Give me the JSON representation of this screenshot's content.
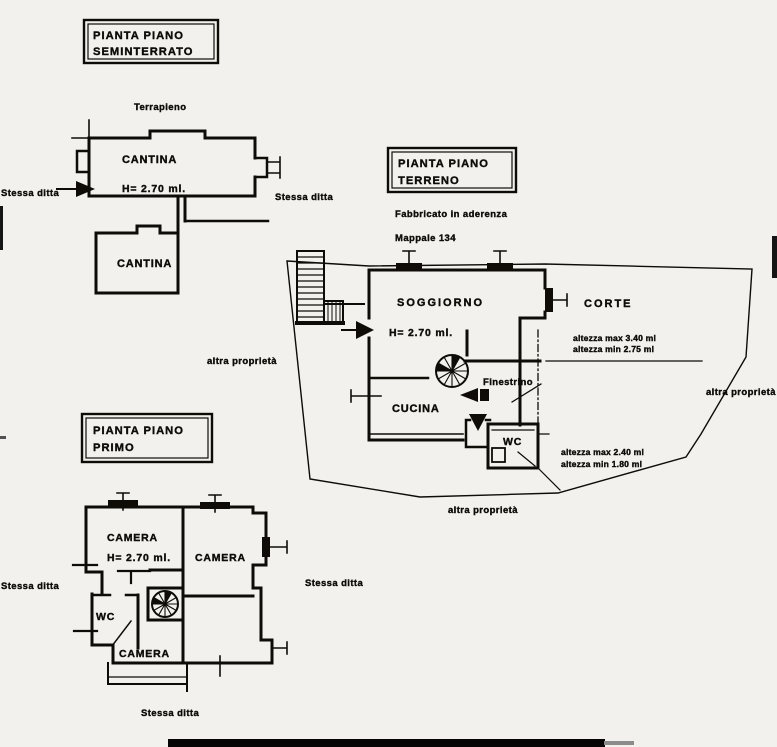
{
  "colors": {
    "paper": "#f2f1ed",
    "ink": "#16140f"
  },
  "seminterrato": {
    "title_line1": "PIANTA PIANO",
    "title_line2": "SEMINTERRATO",
    "note_terrapieno": "Terrapieno",
    "room_cantina_upper": "CANTINA",
    "height_label": "H= 2.70 ml.",
    "room_cantina_lower": "CANTINA",
    "note_left": "Stessa ditta",
    "note_right": "Stessa ditta"
  },
  "terreno": {
    "title_line1": "PIANTA PIANO",
    "title_line2": "TERRENO",
    "note_aderenza": "Fabbricato in aderenza",
    "note_mappale": "Mappale 134",
    "room_soggiorno": "SOGGIORNO",
    "height_label": "H= 2.70 ml.",
    "room_corte": "CORTE",
    "label_finestrino": "Finestrino",
    "room_cucina": "CUCINA",
    "room_wc": "WC",
    "alt_corte_max": "altezza max 3.40 ml",
    "alt_corte_min": "altezza min 2.75 ml",
    "alt_wc_max": "altezza max 2.40 ml",
    "alt_wc_min": "altezza min 1.80 ml",
    "note_left": "altra proprietà",
    "note_right": "altra proprietà",
    "note_bottom": "altra proprietà"
  },
  "primo": {
    "title_line1": "PIANTA PIANO",
    "title_line2": "PRIMO",
    "room_camera_1": "CAMERA",
    "height_label": "H= 2.70 ml.",
    "room_camera_2": "CAMERA",
    "room_wc": "WC",
    "room_camera_3": "CAMERA",
    "note_left": "Stessa ditta",
    "note_right": "Stessa ditta",
    "note_bottom": "Stessa ditta"
  }
}
